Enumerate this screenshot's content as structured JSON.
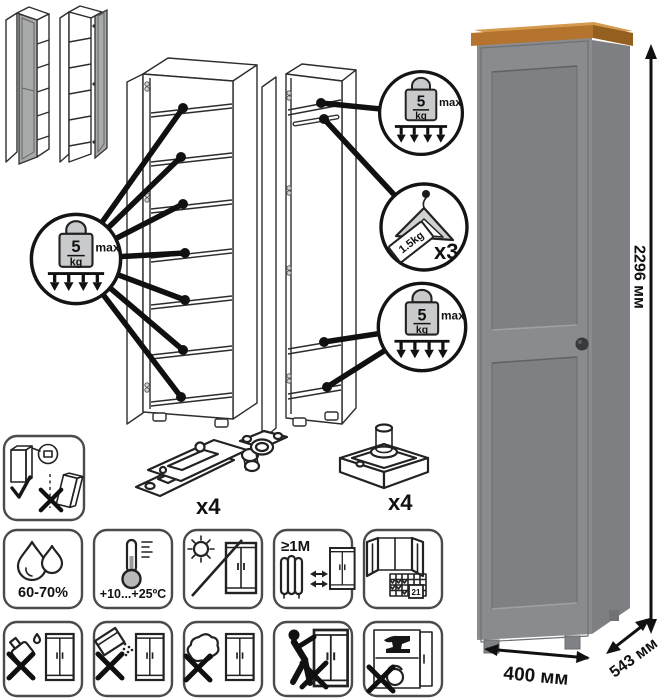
{
  "dimensions": {
    "height": "2296 мм",
    "width": "400 мм",
    "depth": "543 мм"
  },
  "load": {
    "weight_value": "5",
    "weight_unit": "kg",
    "weight_max": "max",
    "hanger_tag": "1.5kg",
    "hanger_count": "x3"
  },
  "hardware": {
    "hinge_count": "x4",
    "foot_count": "x4"
  },
  "care": {
    "humidity": "60-70%",
    "temperature": "+10...+25ºC",
    "min_distance": "≥1М",
    "calendar_day": "21"
  },
  "colors": {
    "front": "#898b8e",
    "side": "#7d7f82",
    "wood_top": "#d49a4e",
    "wood_edge": "#b5742d",
    "wood_side": "#94601f",
    "panel": "#7e8082",
    "thumb_door": "#a7a9ab"
  }
}
